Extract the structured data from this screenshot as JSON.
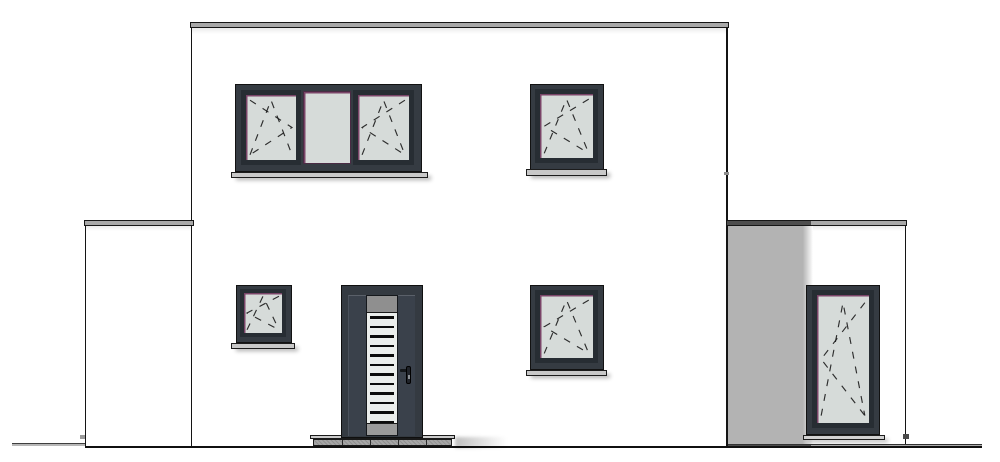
{
  "drawing": {
    "kind": "house-front-elevation",
    "style": "architectural line drawing, flat-roof modern house",
    "storeys": 2,
    "wings": [
      "left-flat-roof-wing",
      "main-two-storey-block",
      "right-flat-roof-wing"
    ]
  },
  "palette": {
    "background": "#ffffff",
    "outline": "#141414",
    "frame_dark": "#353b42",
    "sash_dark": "#272d33",
    "glass": "#d6dbd9",
    "glass_accent": "#7a4468",
    "louver_glass": "#ebeeec",
    "roof_gray": "#a8a8a8",
    "roof_shade": "#4e4e4e",
    "wall_shade": "#b3b3b3",
    "sill_gray": "#c8c8c8",
    "door_frame": "#343a41",
    "door_leaf": "#3a414b",
    "panel_gray": "#8f8f8f",
    "step_top": "#cccccc",
    "step_base": "#a0a0a0",
    "pavement": "#acacac",
    "pavement_shade": "#4b4b4b"
  },
  "door": {
    "louver_count": 12,
    "step_segment_count": 5
  },
  "windows": {
    "upper_triple": "three-part window, two tilt-turn casements flanking fixed pane",
    "upper_right": "single tilt-turn casement window",
    "lower_left_small": "small tilt-turn casement window",
    "lower_right": "single tilt-turn casement window",
    "right_wing_tall": "tall floor-level tilt-turn window"
  }
}
